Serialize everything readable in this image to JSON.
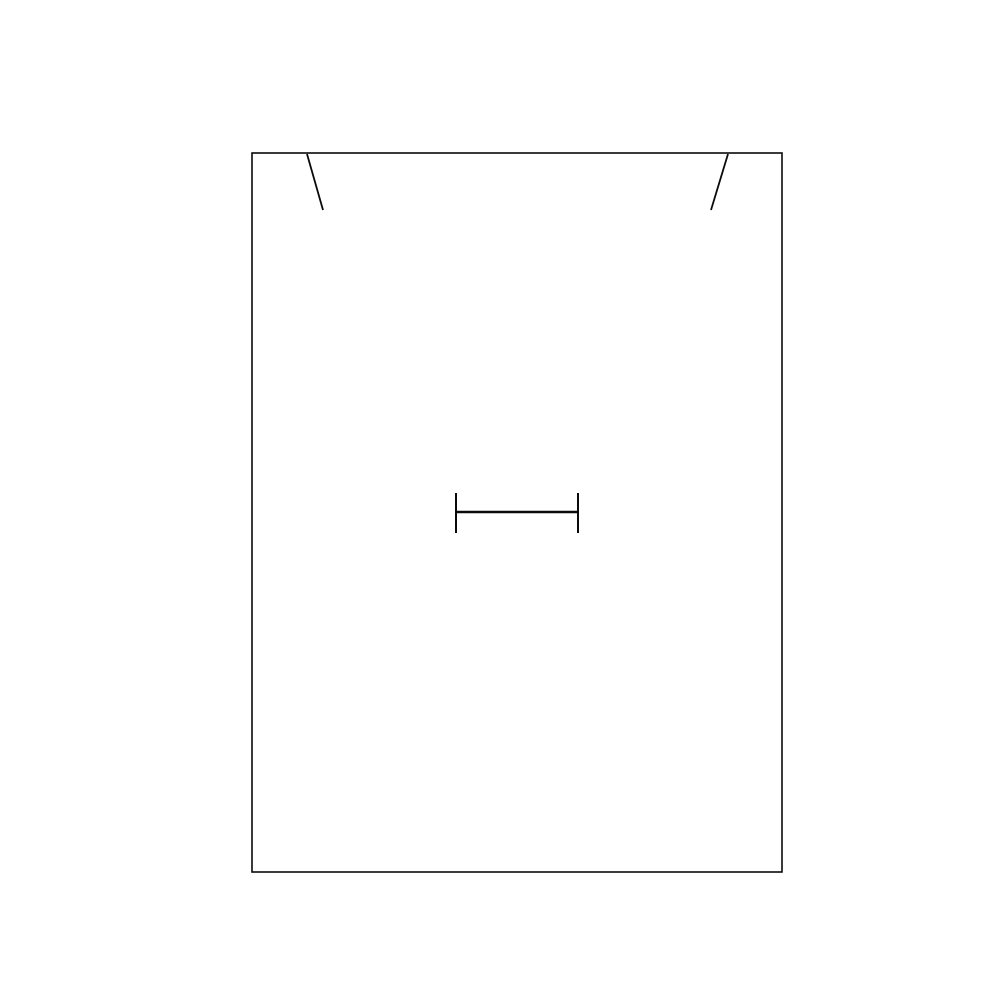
{
  "canvas": {
    "width": 1000,
    "height": 1000,
    "background_color": "#ffffff"
  },
  "drawing": {
    "stroke_color": "#0a0a0a",
    "fill": "none",
    "rectangle": {
      "name": "outer-rectangle",
      "x": 252,
      "y": 153,
      "width": 530,
      "height": 719,
      "stroke_width": 1.6
    },
    "lines": [
      {
        "name": "top-left-notch-line",
        "x1": 307,
        "y1": 154,
        "x2": 323,
        "y2": 210,
        "stroke_width": 1.8
      },
      {
        "name": "top-right-notch-line",
        "x1": 728,
        "y1": 154,
        "x2": 711,
        "y2": 210,
        "stroke_width": 1.8
      },
      {
        "name": "center-slot-horizontal-line",
        "x1": 456,
        "y1": 512,
        "x2": 578,
        "y2": 512,
        "stroke_width": 2.4
      },
      {
        "name": "center-slot-left-cap-line",
        "x1": 456,
        "y1": 493,
        "x2": 456,
        "y2": 533,
        "stroke_width": 2.0
      },
      {
        "name": "center-slot-right-cap-line",
        "x1": 578,
        "y1": 493,
        "x2": 578,
        "y2": 533,
        "stroke_width": 2.0
      }
    ]
  }
}
